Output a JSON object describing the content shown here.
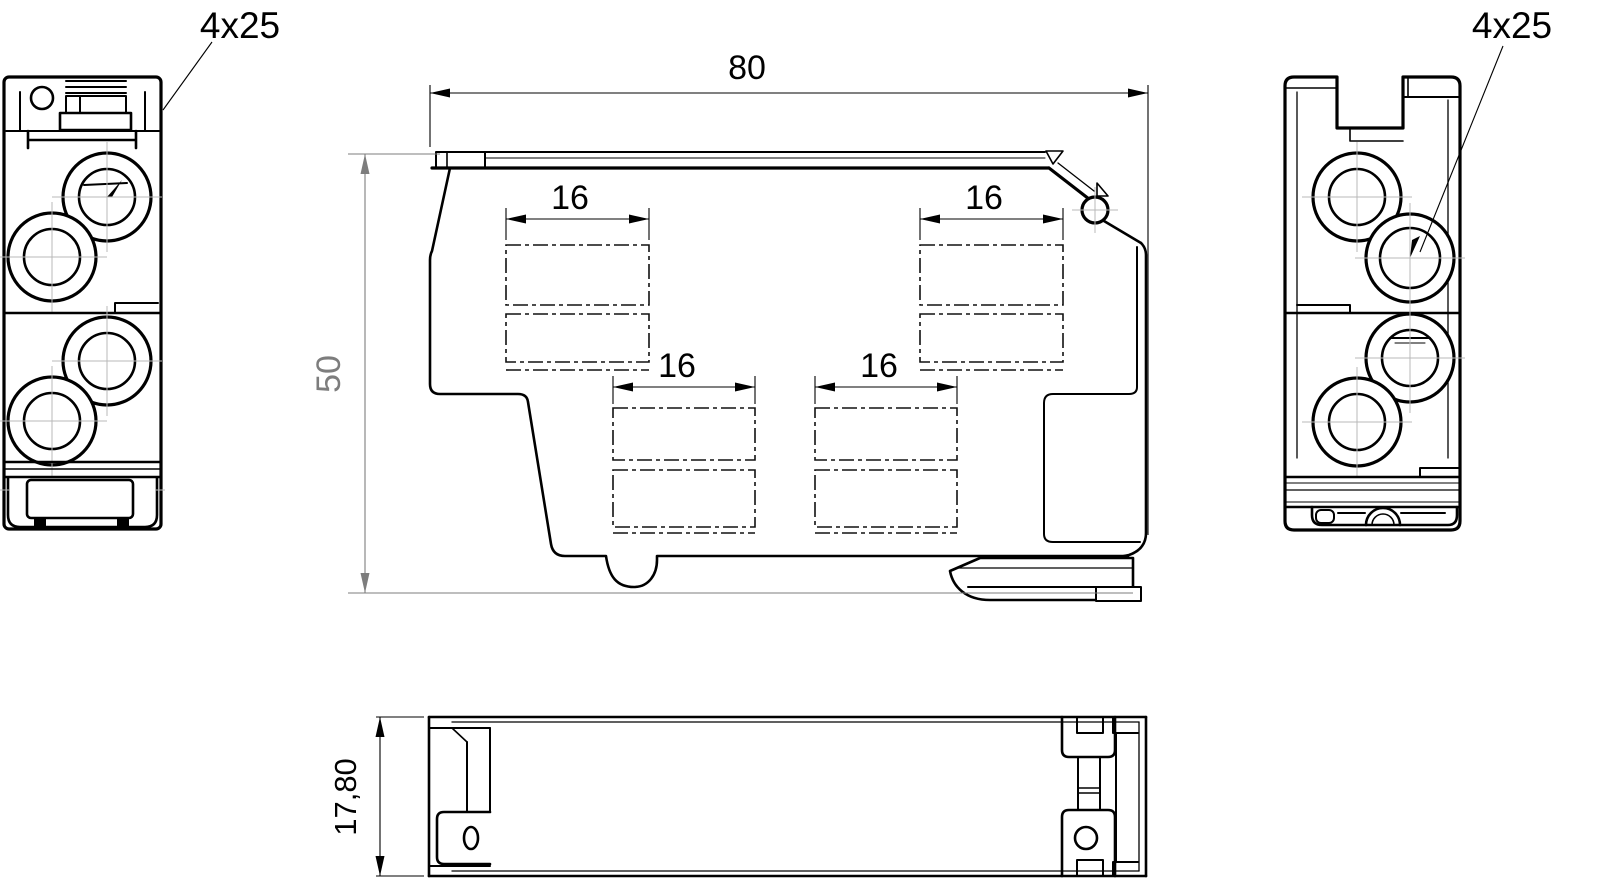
{
  "drawing": {
    "kind": "technical-dimension-drawing",
    "units": "mm"
  },
  "labels": {
    "screw_spec_left": "4x25",
    "screw_spec_right": "4x25"
  },
  "dimensions": {
    "overall_width": {
      "value": "80"
    },
    "overall_height": {
      "value": "50"
    },
    "pitch_upper_left": {
      "value": "16"
    },
    "pitch_upper_right": {
      "value": "16"
    },
    "pitch_lower_left": {
      "value": "16"
    },
    "pitch_lower_right": {
      "value": "16"
    },
    "depth": {
      "value": "17,80"
    }
  },
  "colors": {
    "line": "#000000",
    "dimension_gray": "#7d7d7d",
    "centerline": "#b9b9b9",
    "background": "#ffffff"
  }
}
